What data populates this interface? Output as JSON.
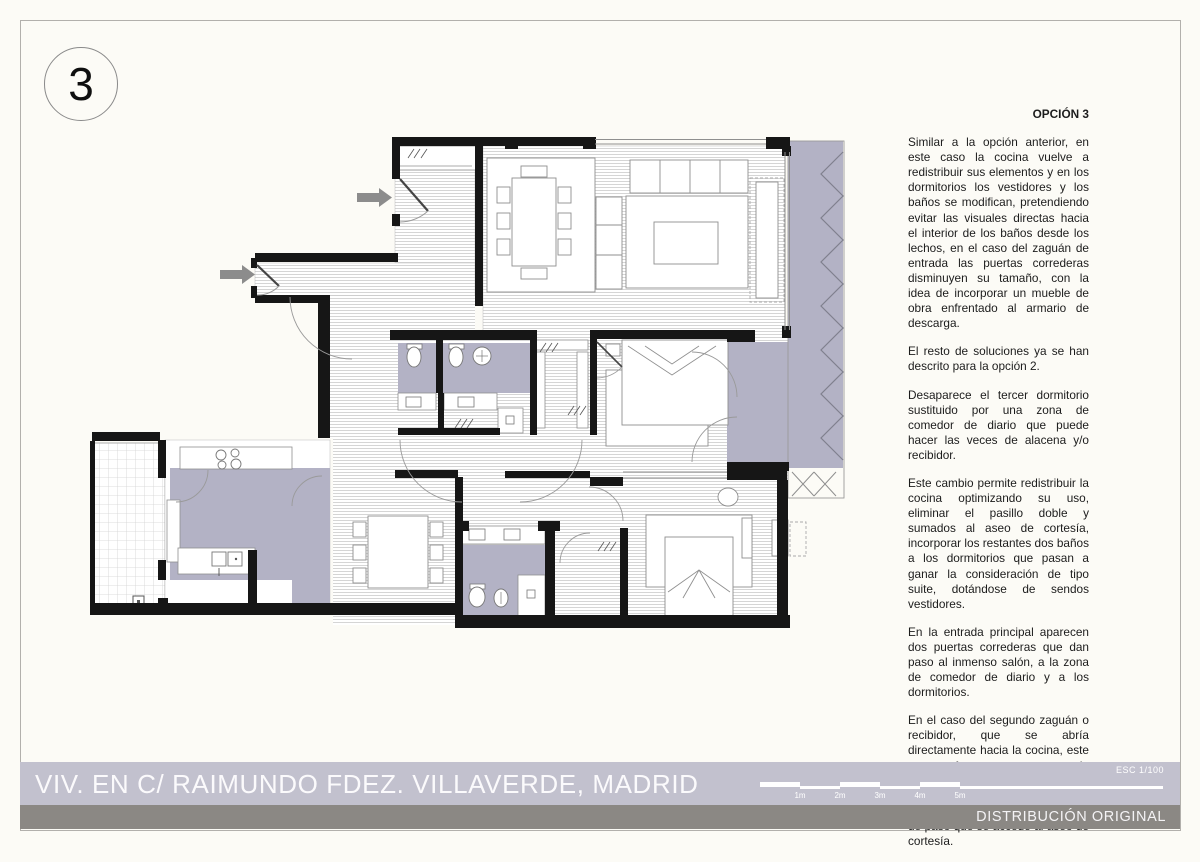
{
  "badge": {
    "number": "3"
  },
  "notes": {
    "title": "OPCIÓN 3",
    "paragraphs": [
      "Similar a la opción anterior, en este caso la cocina vuelve a redistribuir sus elementos y en los dormitorios los vestidores y los baños se modifican, pretendiendo evitar las visuales directas hacia el interior de los baños desde los lechos, en el caso del zaguán de entrada las puertas correderas disminuyen su tamaño, con la idea de incorporar un mueble de obra enfrentado al armario de descarga.",
      "El resto de soluciones ya se han descrito para la opción 2.",
      "Desaparece el tercer dormitorio sustituido por una zona de comedor de diario que puede hacer las veces de alacena y/o recibidor.",
      "Este cambio permite redistribuir la cocina optimizando su uso, eliminar el pasillo doble y sumados al aseo de cortesía, incorporar los restantes dos baños a los dormitorios que pasan a ganar la consideración de tipo suite, dotándose de sendos vestidores.",
      "En la entrada principal aparecen dos puertas correderas que dan paso al inmenso salón, a la zona de comedor de diario y a los dormitorios.",
      "En el caso del segundo zaguán o recibidor, que se abría directamente hacia la cocina, este se transforma en una zona de pasillo y armarios, que sirve al conjunto, desapareciendo el doble pasillo y es a través de esta zona de paso que se accede al aseo de cortesía."
    ]
  },
  "footer": {
    "project_title": "VIV. EN C/ RAIMUNDO FDEZ. VILLAVERDE, MADRID",
    "scale_label": "ESC 1/100",
    "scale_ticks": [
      "1m",
      "2m",
      "3m",
      "4m",
      "5m"
    ],
    "variant_label": "DISTRIBUCIÓN ORIGINAL"
  },
  "colors": {
    "terrace_lavender": "#b3b2c5",
    "bar_light": "#c2c1ce",
    "bar_dark": "#8b8884",
    "arrow_gray": "#8c8c8c",
    "wall_black": "#161616"
  }
}
